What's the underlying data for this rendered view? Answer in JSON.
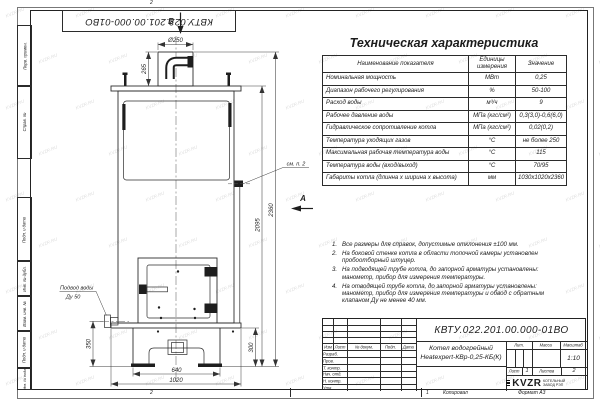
{
  "sheet": {
    "watermark": "KVZR.RU",
    "top_doc_number": "КВТУ.022.201.00.000-01ВО",
    "fold_top": "2",
    "fold_bottom_left": "2",
    "fold_bottom_right": "1",
    "footer_copied": "Копировал",
    "footer_format": "Формат А3",
    "side_labels": [
      "Перв. примен.",
      "Справ. №",
      "Подп. и дата",
      "Инв. № дубл.",
      "Взам. инв. №",
      "Подп. и дата",
      "Инв. № подл."
    ]
  },
  "spec_table": {
    "title": "Техническая характеристика",
    "headers": [
      "Наименование показателя",
      "Единицы измерения",
      "Значение"
    ],
    "rows": [
      [
        "Номинальная мощность",
        "МВт",
        "0,25"
      ],
      [
        "Диапазон рабочего регулирования",
        "%",
        "50-100"
      ],
      [
        "Расход воды",
        "м³/ч",
        "9"
      ],
      [
        "Рабочее давление воды",
        "МПа (кгс/см²)",
        "0,3(3,0)-0,6(6,0)"
      ],
      [
        "Гидравлическое сопротивление котла",
        "МПа (кгс/см²)",
        "0,02(0,2)"
      ],
      [
        "Температура уходящих газов",
        "°С",
        "не более 250"
      ],
      [
        "Максимальная рабочая температура воды",
        "°С",
        "115"
      ],
      [
        "Температура воды (вход/выход)",
        "°С",
        "70/95"
      ],
      [
        "Габариты котла (длинна х ширина х высота)",
        "мм",
        "1030х1020х2360"
      ]
    ]
  },
  "notes": [
    "Все размеры для справок, допустимые отклонения ±100 мм.",
    "На боковой стенке котла в области топочной камеры установлен пробоотборный штуцер.",
    "На подводящей трубе котла, до запорной арматуры установлены: манометр, прибор для измерения температуры.",
    "На отводящей трубе котла, до запорной арматуры установлены: манометр, прибор для измерения температуры и обвод с обратным клапаном Ду не менее 40 мм."
  ],
  "drawing": {
    "dim_d250": "Ø250",
    "dim_265": "265",
    "dim_2360": "2360",
    "dim_2095": "2095",
    "dim_350": "350",
    "dim_300": "300",
    "dim_640": "640",
    "dim_1020": "1020",
    "view_b": "Б",
    "view_a": "А",
    "see_note_2": "см. п. 2",
    "water_line1": "Подвод воды",
    "water_line2": "Ду 50"
  },
  "title_block": {
    "doc_number": "КВТУ.022.201.00.000-01ВО",
    "product_line1": "Котел водогрейный",
    "product_line2": "Heatexpert-КВр-0,25-КБ(К)",
    "header_cols": [
      "Изм",
      "Лист",
      "№ докум.",
      "Подп.",
      "Дата"
    ],
    "sig_rows": [
      "Разраб.",
      "Пров.",
      "Т. контр.",
      "Нач. отд.",
      "Н. контр.",
      "Утв."
    ],
    "lit_label": "Лит.",
    "mass_label": "Масса",
    "scale_label": "Масштаб",
    "scale_value": "1:10",
    "sheet_label": "Лист",
    "sheet_value": "1",
    "sheets_label": "Листов",
    "sheets_value": "2",
    "logo": "KVZR",
    "logo_caption_1": "КОТЕЛЬНЫЙ",
    "logo_caption_2": "ЗАВОД РЭП"
  }
}
